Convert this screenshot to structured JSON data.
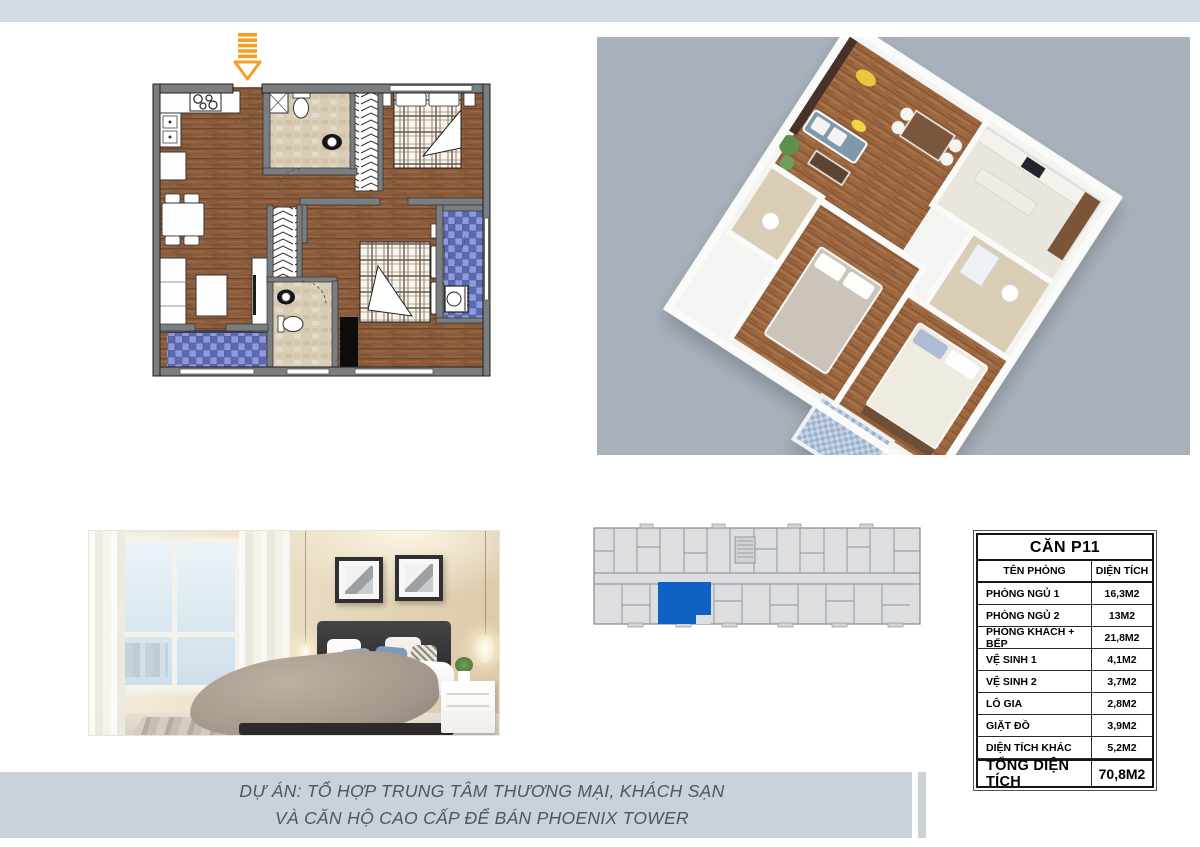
{
  "page": {
    "kind": "apartment floor-plan brochure sheet",
    "background": "#ffffff"
  },
  "colors": {
    "top_bar": "#d4dbe1",
    "panel_3d_bg": "#a9b2bb",
    "footer_bar": "#cbd1d8",
    "footer_text": "#4e565c",
    "accent_blue": "#0f62c2",
    "arrow_orange": "#f2a024",
    "wood": "#8a5c3c",
    "balcony_blue": "#7b8cd1",
    "bathroom_beige": "#d9cdb6",
    "wall_gray": "#7b7e81"
  },
  "icons": {
    "entrance_arrow": "striped-down-arrow"
  },
  "unit_table": {
    "title": "CĂN P11",
    "col_name": "TÊN PHÒNG",
    "col_area": "DIỆN TÍCH",
    "rows": [
      {
        "name": "PHÒNG NGỦ 1",
        "area": "16,3M2"
      },
      {
        "name": "PHÒNG NGỦ 2",
        "area": "13M2"
      },
      {
        "name": "PHÒNG KHÁCH + BẾP",
        "area": "21,8M2"
      },
      {
        "name": "VỆ SINH 1",
        "area": "4,1M2"
      },
      {
        "name": "VỆ SINH 2",
        "area": "3,7M2"
      },
      {
        "name": "LÔ GIA",
        "area": "2,8M2"
      },
      {
        "name": "GIẶT ĐỒ",
        "area": "3,9M2"
      },
      {
        "name": "DIỆN TÍCH KHÁC",
        "area": "5,2M2"
      }
    ],
    "total_name": "TỔNG DIỆN TÍCH",
    "total_area": "70,8M2"
  },
  "key_plan": {
    "highlighted_unit": "P11",
    "highlight_color": "#0f62c2"
  },
  "footer": {
    "line1": "DỰ ÁN: TỔ HỢP TRUNG TÂM THƯƠNG MẠI, KHÁCH SẠN",
    "line2": "VÀ CĂN HỘ CAO CẤP ĐỂ BÁN PHOENIX TOWER"
  }
}
